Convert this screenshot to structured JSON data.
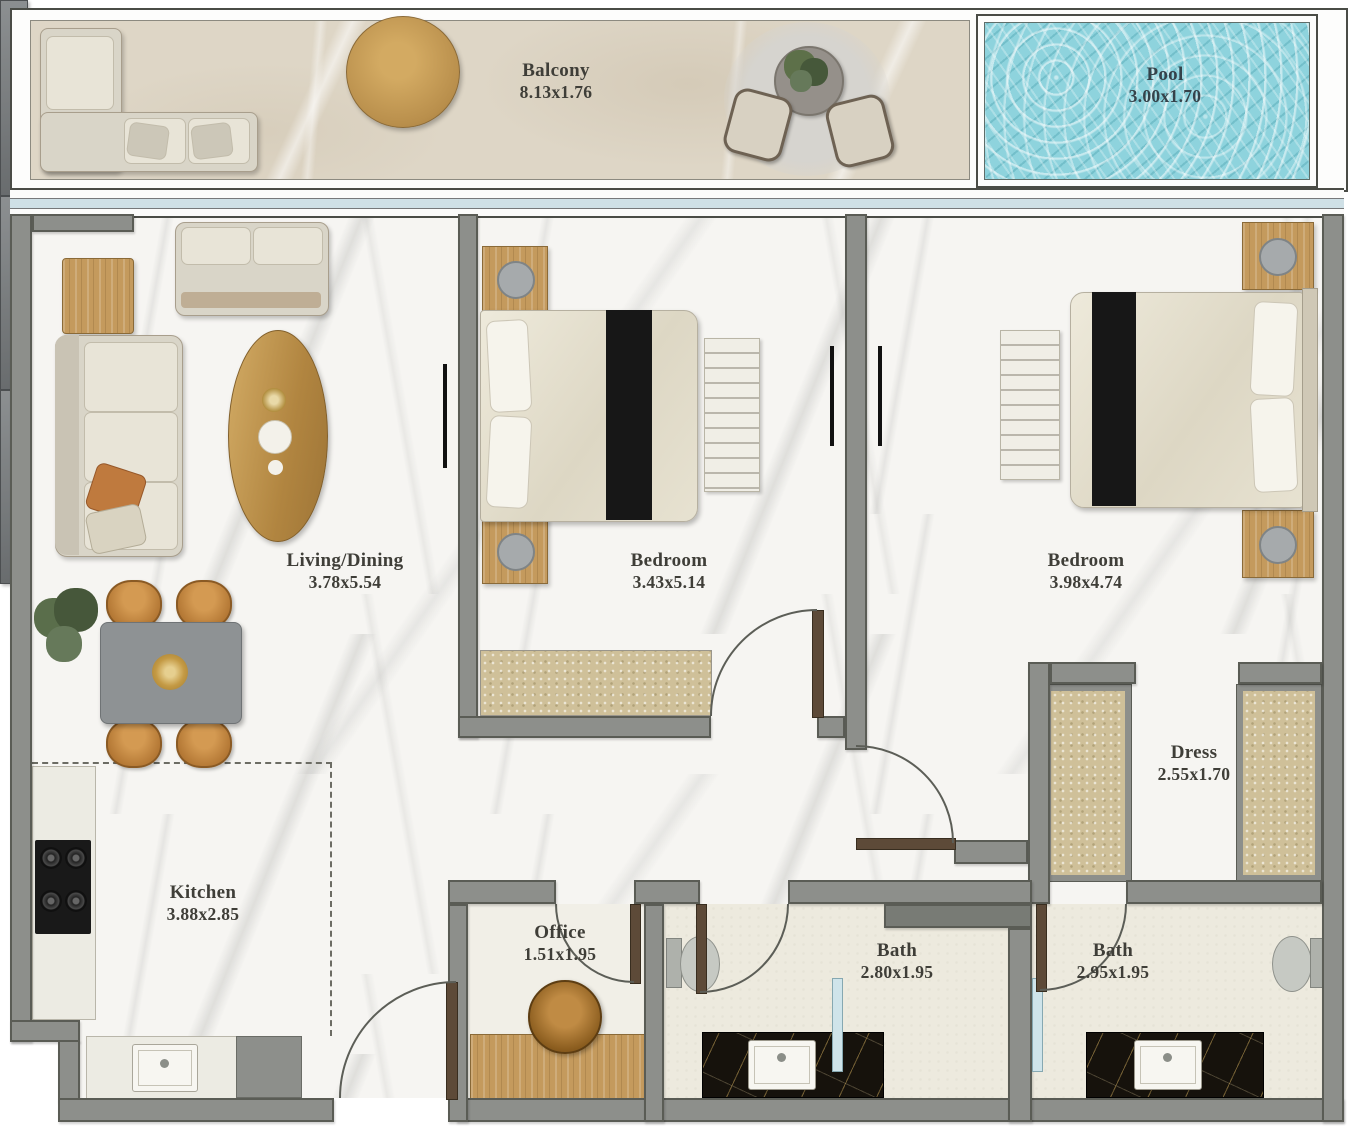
{
  "rooms": {
    "balcony": {
      "label": "Balcony",
      "dims": "8.13x1.76"
    },
    "pool": {
      "label": "Pool",
      "dims": "3.00x1.70"
    },
    "living_dining": {
      "label": "Living/Dining",
      "dims": "3.78x5.54"
    },
    "bedroom_1": {
      "label": "Bedroom",
      "dims": "3.43x5.14"
    },
    "bedroom_2": {
      "label": "Bedroom",
      "dims": "3.98x4.74"
    },
    "kitchen": {
      "label": "Kitchen",
      "dims": "3.88x2.85"
    },
    "office": {
      "label": "Office",
      "dims": "1.51x1.95"
    },
    "bath_1": {
      "label": "Bath",
      "dims": "2.80x1.95"
    },
    "bath_2": {
      "label": "Bath",
      "dims": "2.95x1.95"
    },
    "dress": {
      "label": "Dress",
      "dims": "2.55x1.70"
    }
  },
  "colors": {
    "wall": "#8d8f8b",
    "wall_outline": "#5a5c55",
    "pool_water": "#8ed3dd",
    "window_glass": "#cfe0e6",
    "balcony_floor": "#ded6c6",
    "interior_floor": "#f6f5f2",
    "bath_floor": "#edeade",
    "wood_accent": "#c49a5d",
    "label_text": "#3f3e38"
  }
}
